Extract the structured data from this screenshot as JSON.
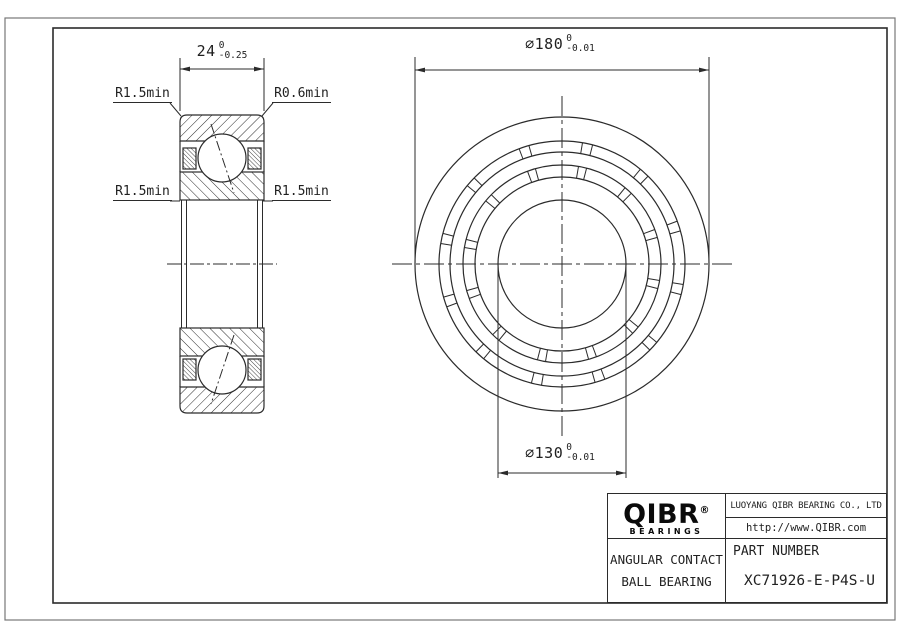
{
  "drawing": {
    "left_view": {
      "width_dim": {
        "value": "24",
        "tol_upper": "0",
        "tol_lower": "-0.25"
      },
      "labels": {
        "top_left": "R1.5min",
        "top_right": "R0.6min",
        "mid_left": "R1.5min",
        "mid_right": "R1.5min"
      }
    },
    "front_view": {
      "od_dim": {
        "symbol": "⌀",
        "value": "180",
        "tol_upper": "0",
        "tol_lower": "-0.01"
      },
      "bore_dim": {
        "symbol": "⌀",
        "value": "130",
        "tol_upper": "0",
        "tol_lower": "-0.01"
      }
    }
  },
  "title_block": {
    "logo": {
      "text": "QIBR",
      "registered": "®",
      "sub": "BEARINGS"
    },
    "company": "LUOYANG QIBR BEARING CO., LTD",
    "website": "http://www.QIBR.com",
    "product_line1": "ANGULAR CONTACT",
    "product_line2": "BALL BEARING",
    "part_number_label": "PART NUMBER",
    "part_number": "XC71926-E-P4S-U"
  },
  "colors": {
    "line": "#2b2b2b",
    "background": "#ffffff"
  }
}
